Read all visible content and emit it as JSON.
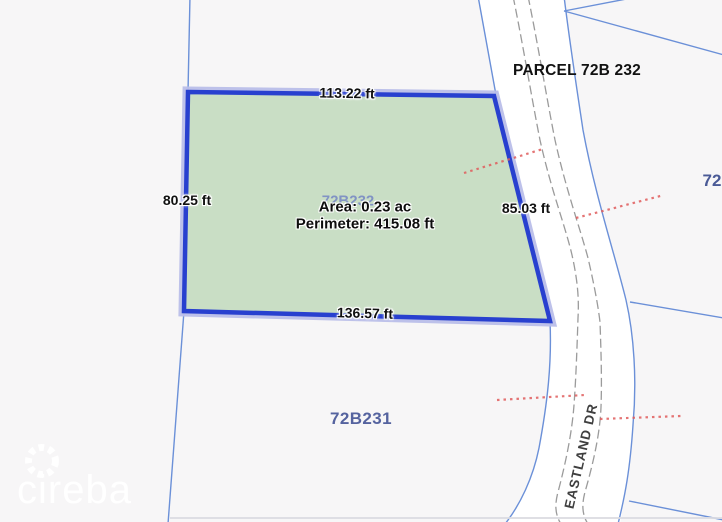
{
  "map": {
    "selected_parcel": {
      "map_label": "72B232",
      "area": "Area: 0.23 ac",
      "perimeter": "Perimeter: 415.08 ft",
      "side_top": "113.22 ft",
      "side_left": "80.25 ft",
      "side_right": "85.03 ft",
      "side_bottom": "136.57 ft"
    },
    "neighbor_labels": {
      "right_parcel": "PARCEL 72B 232",
      "bottom_parcel": "72B231",
      "edge_parcel_partial": "72",
      "road": "EASTLAND DR"
    },
    "watermark": {
      "text": "cireba"
    },
    "colors": {
      "background": "#f7f6f7",
      "parcel_fill": "#c9dec5",
      "parcel_border": "#2840cf",
      "parcel_halo": "#b9bee9",
      "boundary_blue": "#6b90d8",
      "road_fill": "#ffffff",
      "road_casing": "#9b9b9b",
      "survey_red": "#e05c5c",
      "parcel_text_blue": "#55639f"
    }
  }
}
